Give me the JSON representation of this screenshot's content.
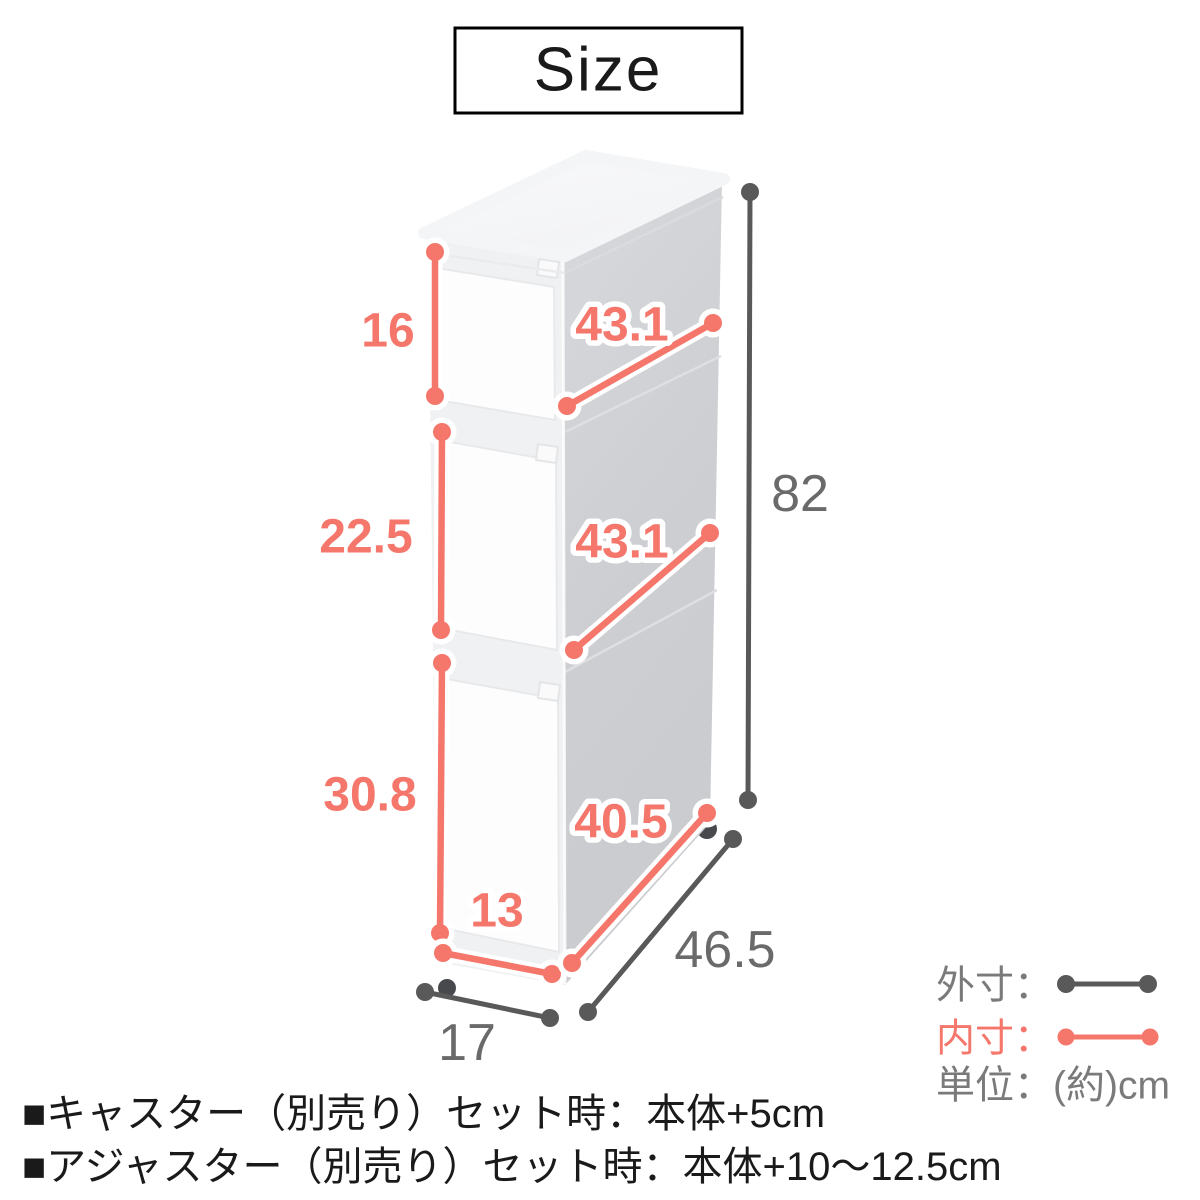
{
  "title": "Size",
  "figure": {
    "description": "3-drawer slim white storage cart, 3/4 perspective view",
    "inner_dims": {
      "drawer1_height": "16",
      "drawer2_height": "22.5",
      "drawer3_height": "30.8",
      "drawer3_width": "13",
      "drawer1_depth": "43.1",
      "drawer2_depth": "43.1",
      "drawer3_depth": "40.5"
    },
    "outer_dims": {
      "height": "82",
      "depth": "46.5",
      "width": "17"
    }
  },
  "legend": {
    "outer_label": "外寸：",
    "inner_label": "内寸：",
    "unit_label": "単位：(約)cm"
  },
  "notes": [
    "■キャスター（別売り）セット時：本体+5cm",
    "■アジャスター（別売り）セット時：本体+10〜12.5cm"
  ],
  "colors": {
    "inner_line": "#F5766B",
    "outer_line": "#595959",
    "number_gray": "#6A6A6A",
    "legend_gray": "#7A7A7A",
    "text_black": "#1A1A1A"
  }
}
